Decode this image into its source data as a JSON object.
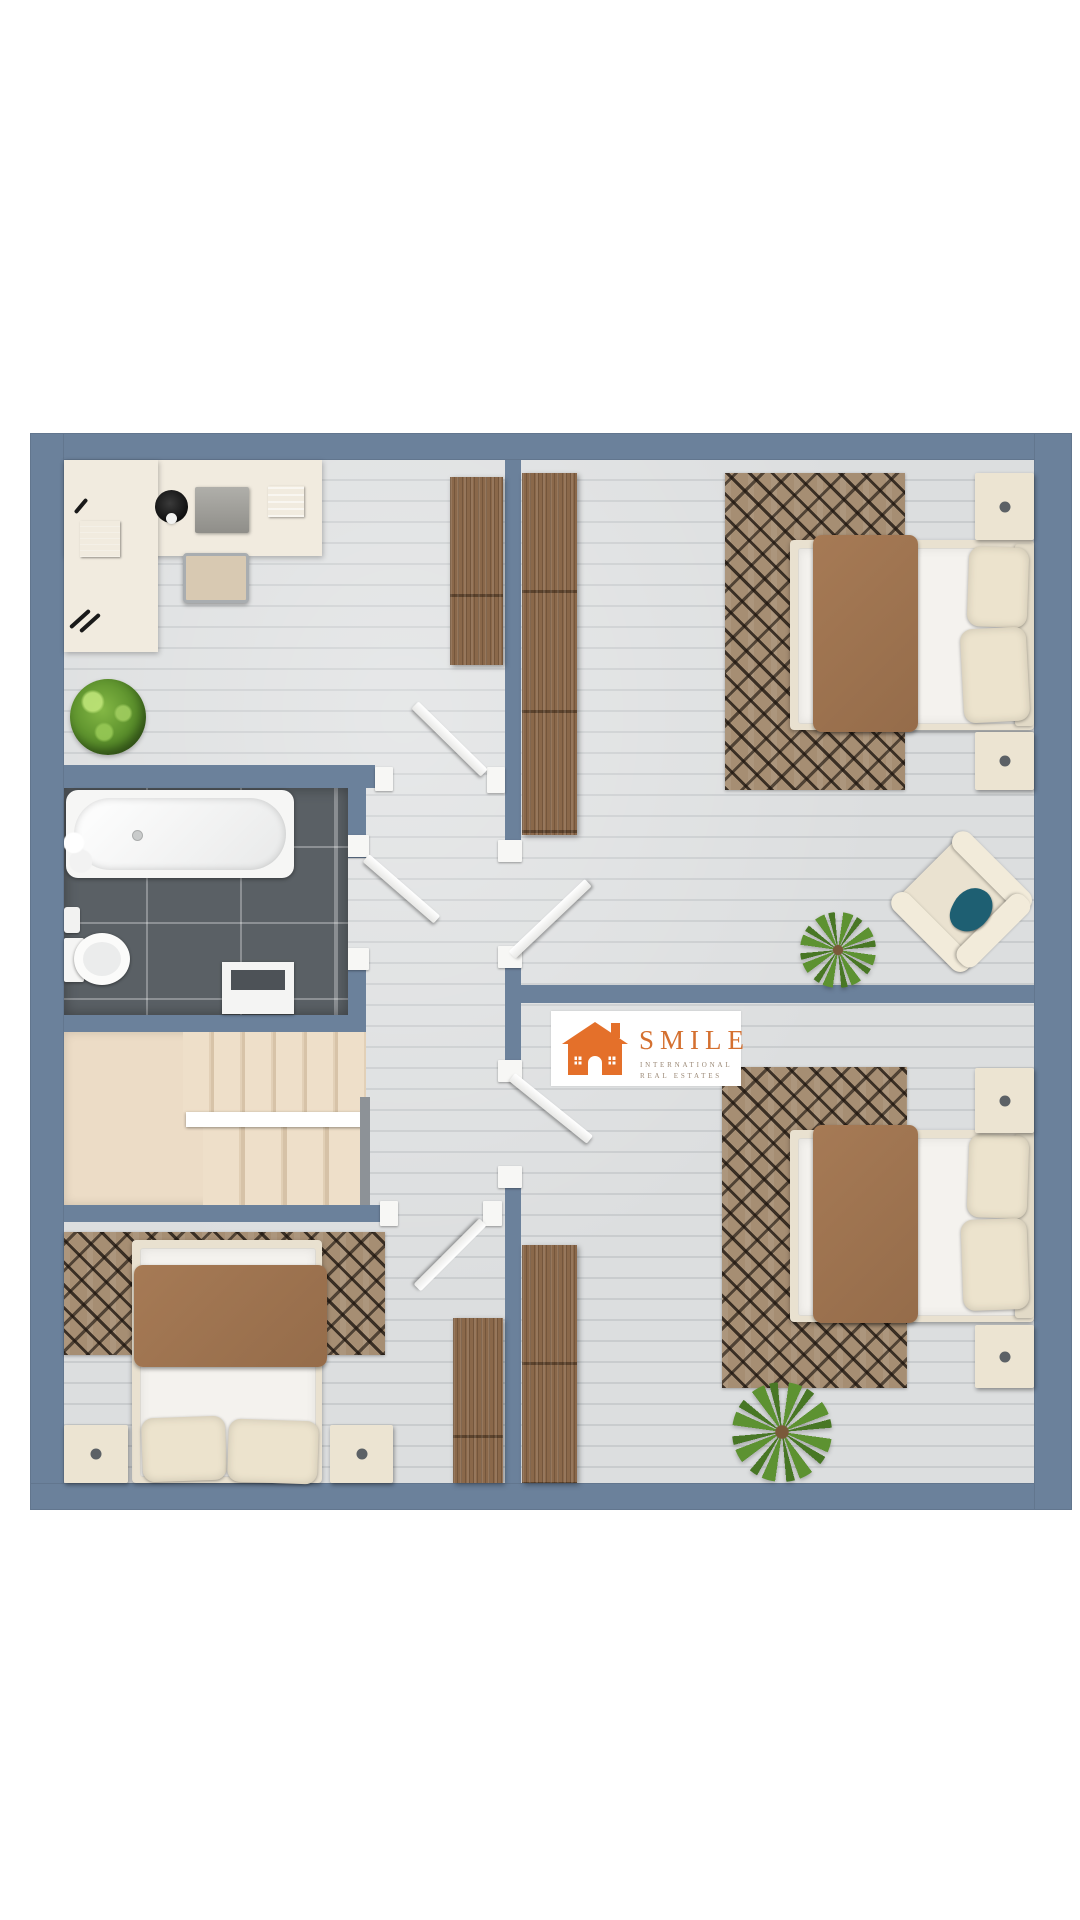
{
  "logo": {
    "brand": "SMILE",
    "subtitle_line1": "INTERNATIONAL",
    "subtitle_line2": "REAL ESTATES",
    "accent_color": "#E4702A",
    "brand_text_color": "#D47030"
  },
  "palette": {
    "background": "#FFFFFF",
    "wall_blue": "#6B819B",
    "wood_floor": "#D6D8D9",
    "bathroom_tile": "#5A6065",
    "stair_beige": "#ECDCC6",
    "rug_base": "#A68E73",
    "rug_pattern_dark": "#2A211B",
    "blanket_brown": "#9E734F",
    "mattress_white": "#F4F2EE",
    "furniture_cream": "#ECE4D2",
    "wardrobe_wood": "#8A684A",
    "door_white": "#F7F7F5",
    "armchair_pillow_teal": "#1E5F72",
    "plant_green": "#5D9231"
  }
}
